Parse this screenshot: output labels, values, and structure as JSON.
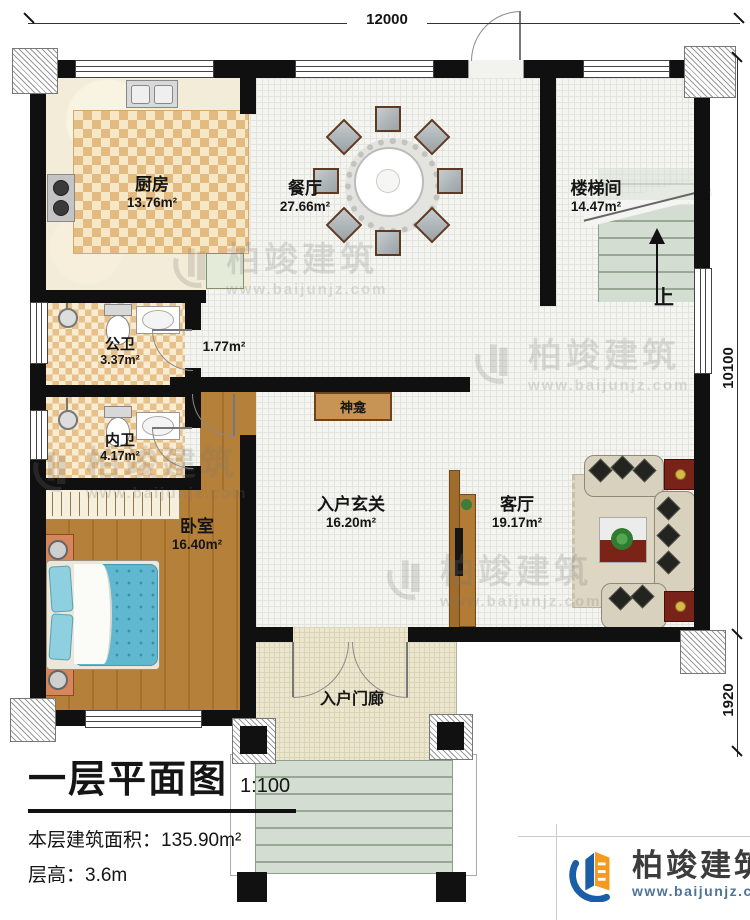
{
  "dimensions": {
    "top": "12000",
    "right_upper": "10100",
    "right_lower": "1920"
  },
  "rooms": {
    "kitchen": {
      "name": "厨房",
      "area": "13.76m²"
    },
    "dining": {
      "name": "餐厅",
      "area": "27.66m²"
    },
    "stairwell": {
      "name": "楼梯间",
      "area": "14.47m²"
    },
    "public_bath": {
      "name": "公卫",
      "area": "3.37m²"
    },
    "inner_bath": {
      "name": "内卫",
      "area": "4.17m²"
    },
    "niche": {
      "area": "1.77m²"
    },
    "bedroom": {
      "name": "卧室",
      "area": "16.40m²"
    },
    "foyer": {
      "name": "入户玄关",
      "area": "16.20m²"
    },
    "living": {
      "name": "客厅",
      "area": "19.17m²"
    },
    "porch": {
      "name": "入户门廊"
    },
    "shrine": {
      "name": "神龛"
    },
    "stairs": {
      "up": "上"
    }
  },
  "title_block": {
    "title": "一层平面图",
    "scale": "1:100",
    "floor_area_label": "本层建筑面积：",
    "floor_area_value": "135.90m²",
    "floor_height_label": "层高：",
    "floor_height_value": "3.6m"
  },
  "brand": {
    "name": "柏竣建筑",
    "website": "www.baijunjz.com"
  },
  "watermark": {
    "name": "柏竣建筑",
    "website": "www.baijunjz.com"
  },
  "colors": {
    "wall": "#101010",
    "brand_blue": "#1b5ea6",
    "brand_orange": "#f59a1e",
    "bed_teal": "#5fb8cf",
    "table_red": "#7c2318",
    "wood": "#af7a33"
  }
}
